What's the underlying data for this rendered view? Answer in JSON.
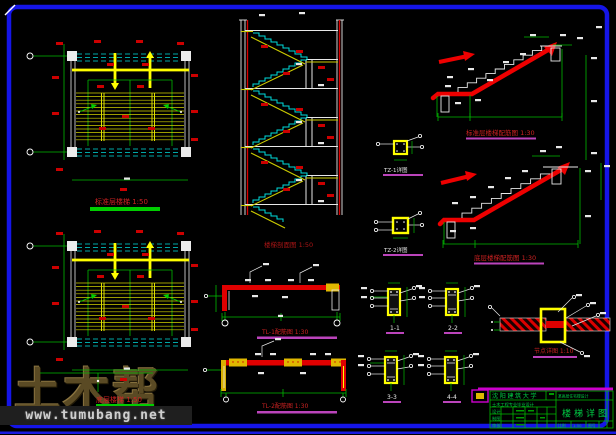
{
  "watermark": {
    "brand": "土木帮",
    "url": "www.tumubang.net"
  },
  "labels": {
    "plan_top": "标准层楼梯 1:50",
    "plan_bottom": "底层楼梯 1:50",
    "section": "楼梯剖面图 1:50",
    "flight_top": "标准层楼梯配筋图 1:30",
    "flight_bottom": "底层楼梯配筋图 1:30",
    "tz1": "TZ-1详图",
    "tz2": "TZ-2详图",
    "beam1": "TL-1配筋图 1:30",
    "beam2": "TL-2配筋图 1:30",
    "sec1": "1-1",
    "sec2": "2-2",
    "sec3": "3-3",
    "sec4": "4-4",
    "splice": "节点详图 1:10"
  },
  "titleblock": {
    "university": "沈阳建筑大学",
    "subtitle": "土木工程专业毕业设计",
    "project": "某高层住宅楼设计",
    "drawing_title": "楼梯详图",
    "row_design": "设计",
    "row_draft": "制图",
    "row_check": "审核",
    "scale_label": "比例",
    "scale_value": "1:50",
    "sheet_label": "图号"
  },
  "colors": {
    "border_blue": "#1515e8",
    "line_yellow": "#ffff00",
    "line_cyan": "#00dddd",
    "line_green": "#00bb00",
    "line_red": "#dd0000",
    "label_magenta": "#bb44bb",
    "watermark_brown": "#5a4a24"
  }
}
